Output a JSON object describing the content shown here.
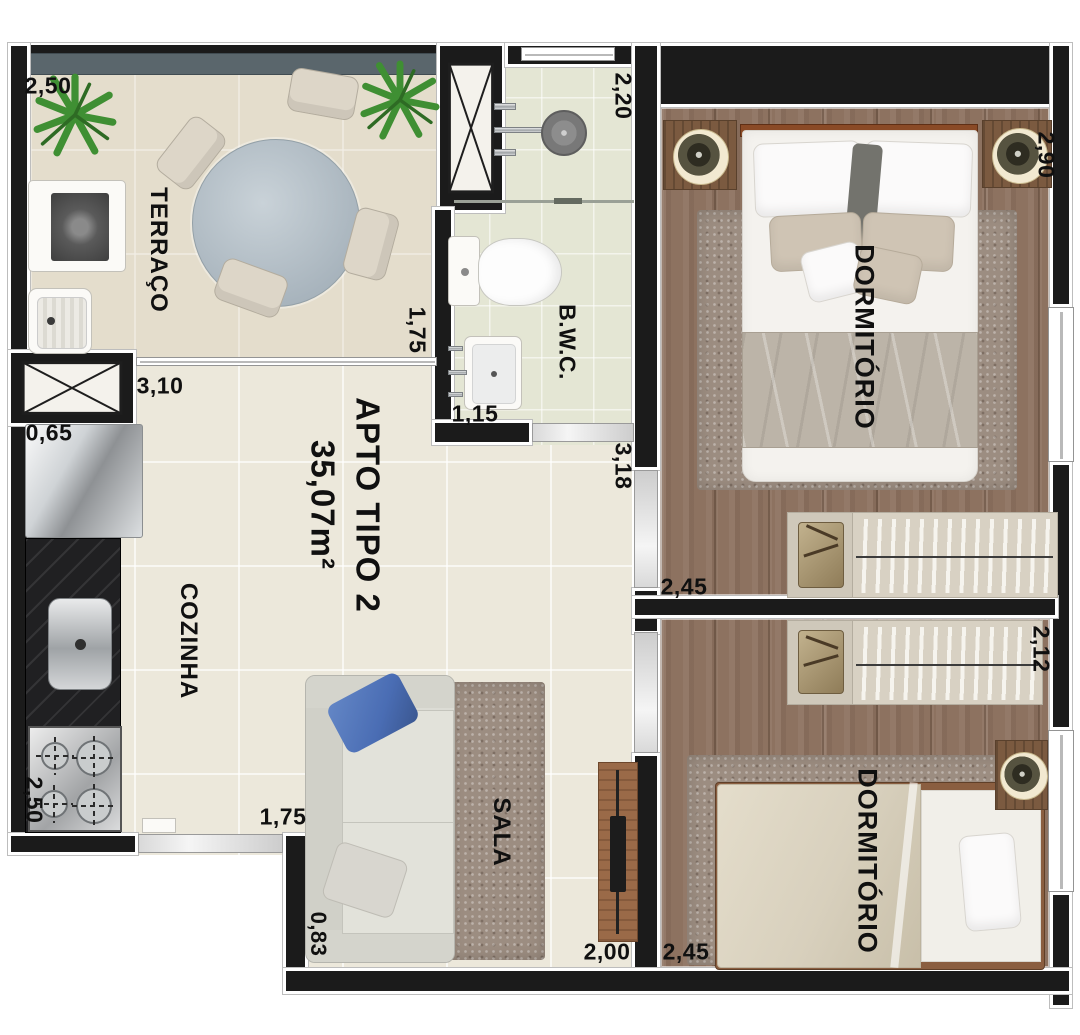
{
  "title": {
    "line1": "APTO TIPO 2",
    "line2": "35,07m²"
  },
  "rooms": {
    "terraco": "TERRAÇO",
    "cozinha": "COZINHA",
    "sala": "SALA",
    "bwc": "B.W.C.",
    "dormitorio1": "DORMITÓRIO",
    "dormitorio2": "DORMITÓRIO"
  },
  "measurements": {
    "terraco_width": "2,50",
    "kitchen_pass": "3,10",
    "shaft_width": "0,65",
    "kitchen_depth": "2,50",
    "entrance_width": "1,75",
    "sala_wall": "0,83",
    "sala_width": "2,00",
    "bwc_width": "2,20",
    "bwc_left": "1,75",
    "bwc_sink": "1,15",
    "hall_height": "3,18",
    "dorm1_width": "2,90",
    "dorm1_depth": "2,45",
    "wardrobe_depth": "2,12",
    "dorm2_width": "2,45"
  },
  "colors": {
    "wall": "#1b1b1b",
    "floor_tile": "#ece8db",
    "bath_tile": "#e4e6d4",
    "wood": "#8d7260",
    "railing": "#5a666c",
    "rug": "#9c8d81",
    "pillow_blue": "#4a6db4"
  }
}
